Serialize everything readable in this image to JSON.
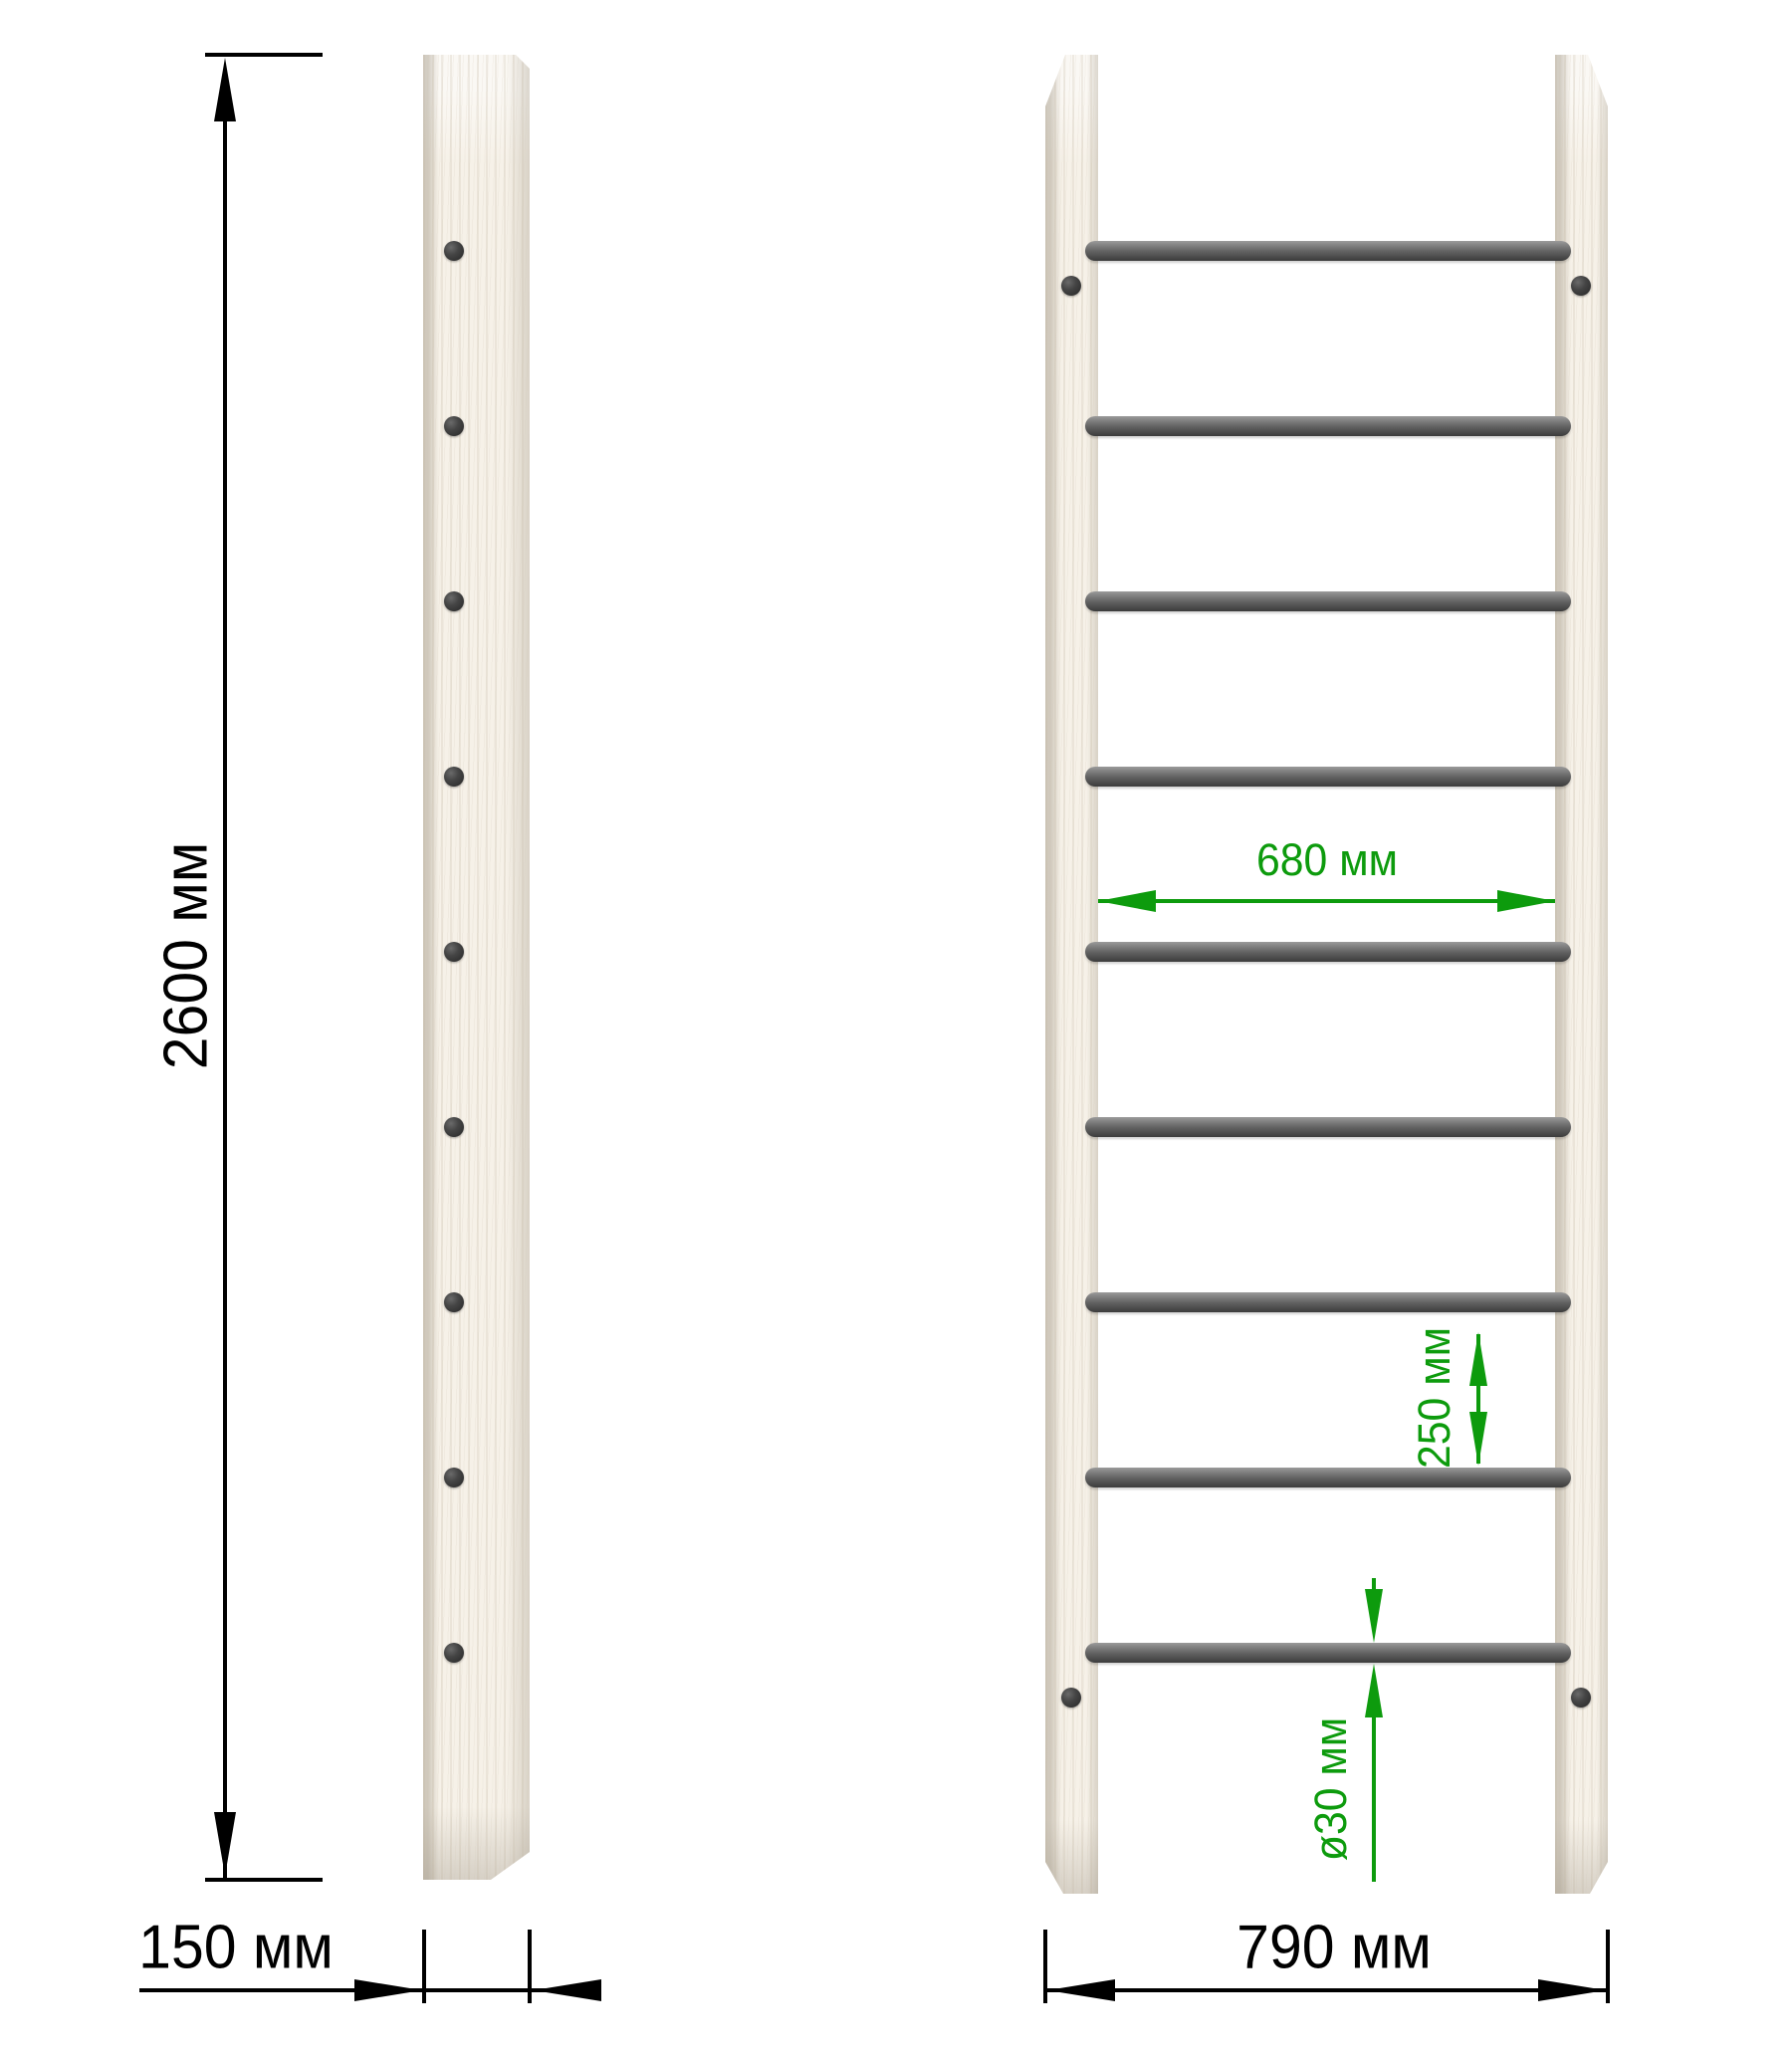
{
  "drawing": {
    "title": "wall-bars dimension drawing",
    "colors": {
      "dimension_black": "#000000",
      "dimension_green": "#0d9b0d",
      "wood_fill": "#f6f1e8",
      "rung_gray": "#5d5d5d",
      "background": "#ffffff"
    },
    "side_view": {
      "height_label": "2600 мм",
      "depth_label": "150 мм",
      "screw_count": 9
    },
    "front_view": {
      "inner_width_label": "680 мм",
      "spacing_label": "250 мм",
      "diameter_label": "ø30 мм",
      "outer_width_label": "790 мм",
      "rung_count": 9,
      "mount_screw_count": 4
    }
  }
}
